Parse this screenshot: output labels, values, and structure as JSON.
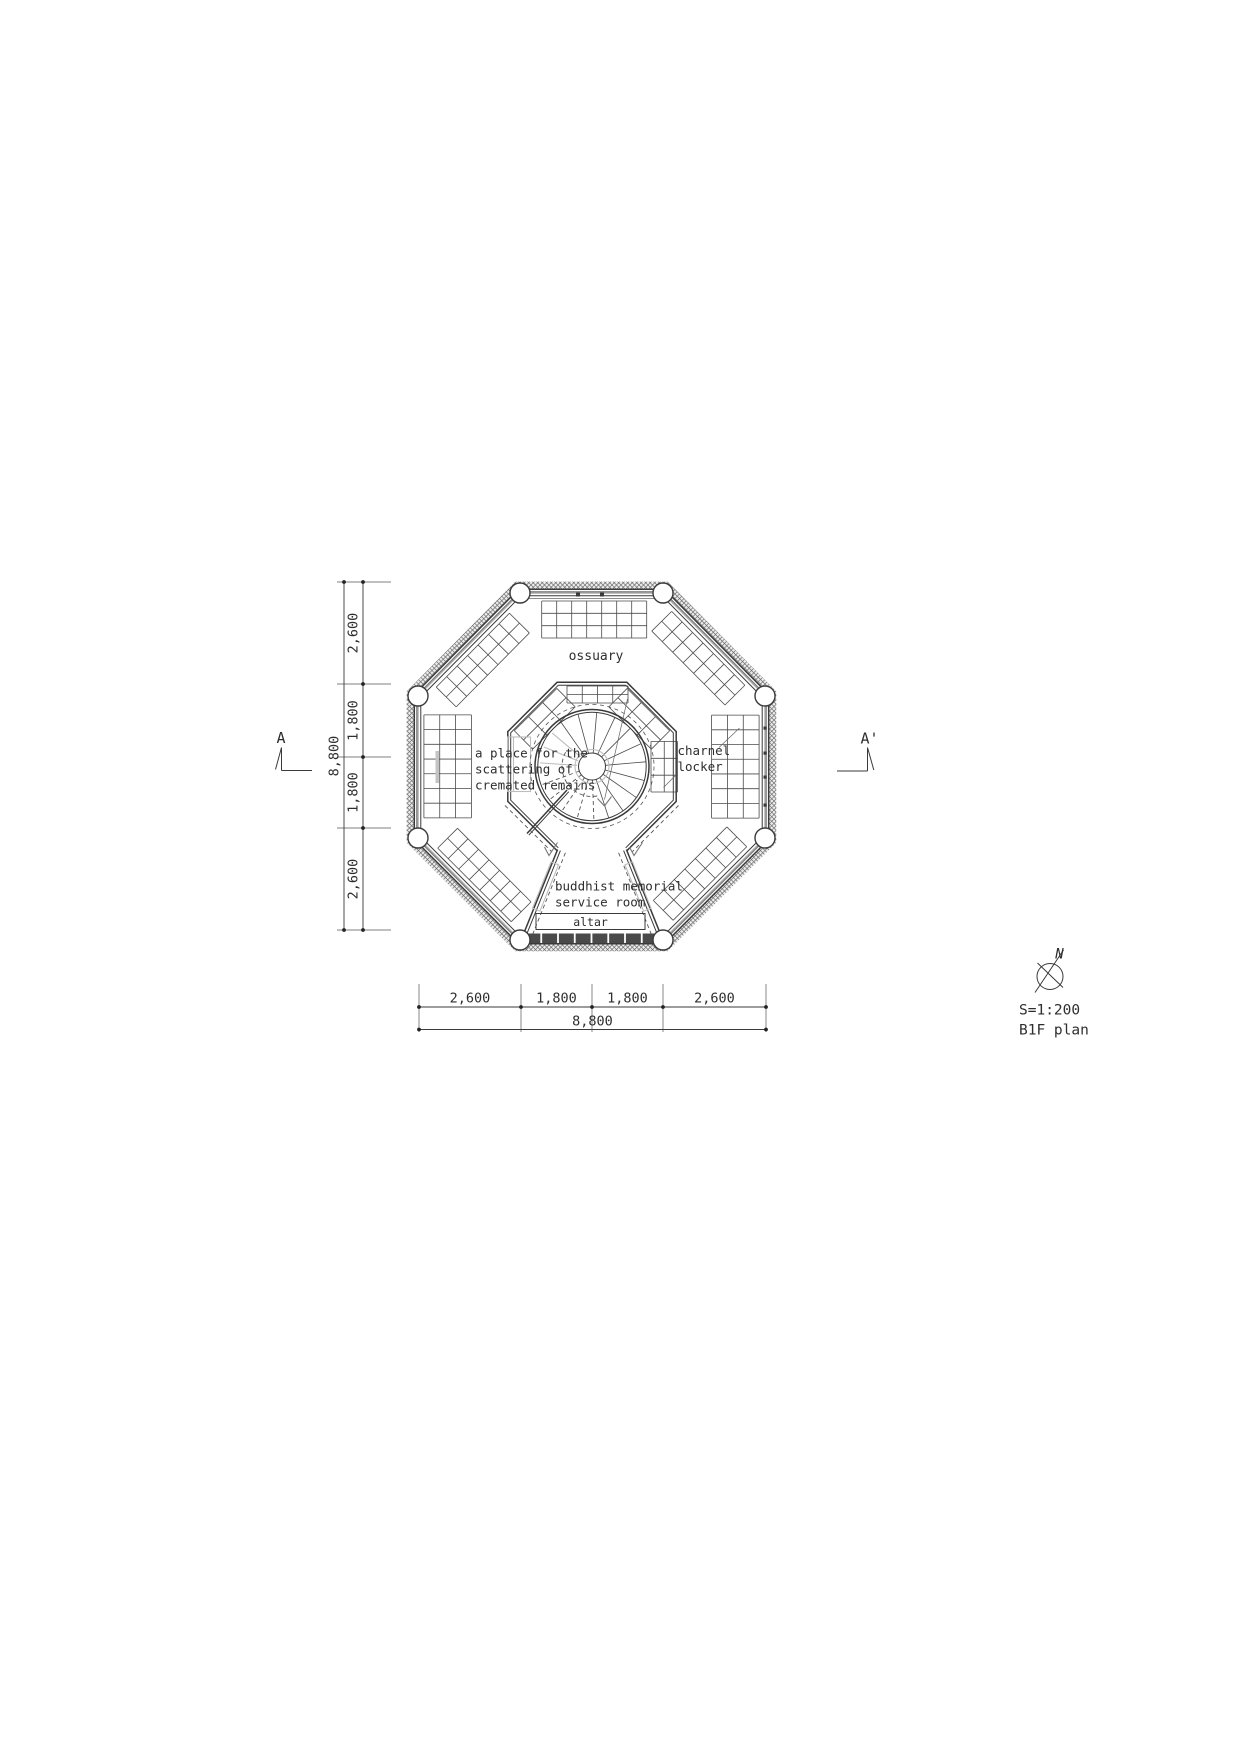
{
  "meta": {
    "scale": "S=1:200",
    "floor": "B1F plan"
  },
  "compass": {
    "north": "N"
  },
  "markers": {
    "left": "A",
    "right": "A'"
  },
  "labels": {
    "ossuary": "ossuary",
    "scattering": [
      "a place for the",
      "scattering of",
      "cremated remains"
    ],
    "charnel": [
      "charnel",
      "locker"
    ],
    "memorial": [
      "buddhist memorial",
      "service room"
    ],
    "altar": "altar"
  },
  "dims": {
    "left": {
      "segments": [
        "2,600",
        "1,800",
        "1,800",
        "2,600"
      ],
      "overall": "8,800"
    },
    "bottom": {
      "segments": [
        "2,600",
        "1,800",
        "1,800",
        "2,600"
      ],
      "overall": "8,800"
    }
  },
  "colors": {
    "line": "#3a3a3a",
    "grid": "#4a4a4a",
    "light": "#bdbdbd"
  }
}
